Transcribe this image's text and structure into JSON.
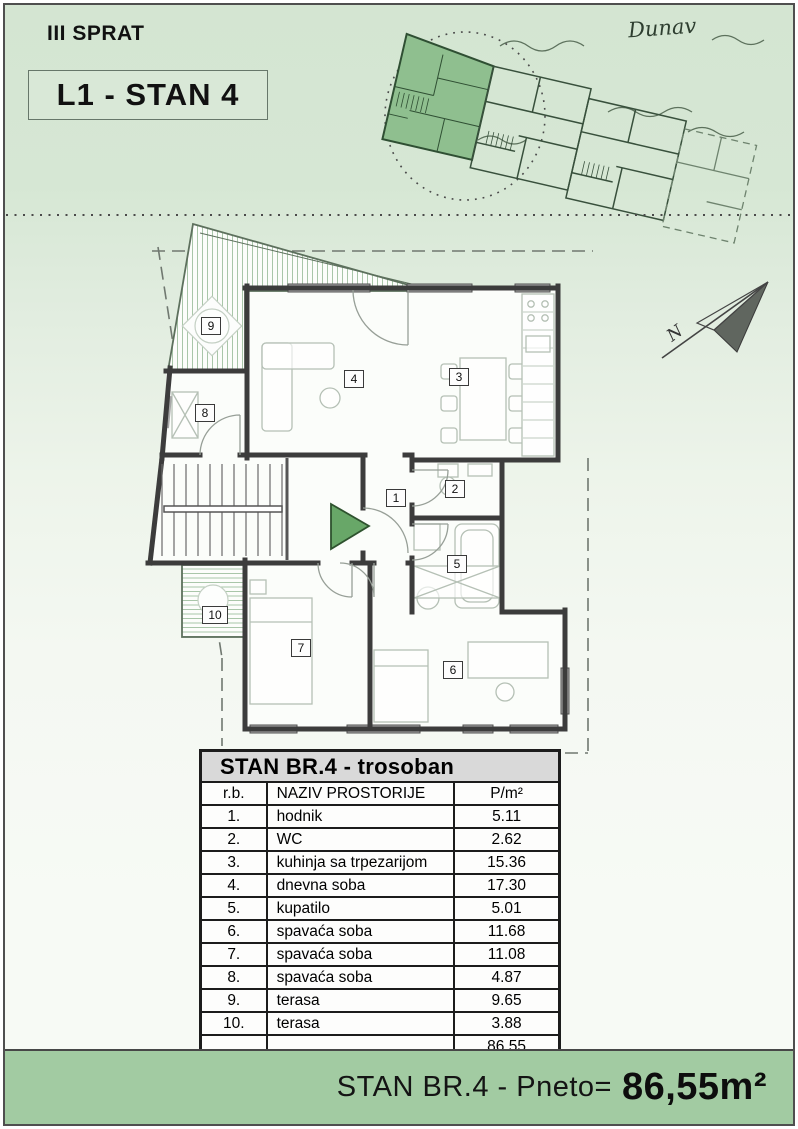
{
  "header": {
    "floor": "III SPRAT",
    "unit": "L1 - STAN 4"
  },
  "overview": {
    "river": "Dunav"
  },
  "compass": {
    "north": "N"
  },
  "plan": {
    "rooms": [
      {
        "num": "1"
      },
      {
        "num": "2"
      },
      {
        "num": "3"
      },
      {
        "num": "4"
      },
      {
        "num": "5"
      },
      {
        "num": "6"
      },
      {
        "num": "7"
      },
      {
        "num": "8"
      },
      {
        "num": "9"
      },
      {
        "num": "10"
      }
    ]
  },
  "table": {
    "title": "STAN BR.4 - trosoban",
    "headers": {
      "rb": "r.b.",
      "name": "NAZIV PROSTORIJE",
      "area": "P/m²"
    },
    "rows": [
      {
        "rb": "1.",
        "name": "hodnik",
        "area": "5.11"
      },
      {
        "rb": "2.",
        "name": "WC",
        "area": "2.62"
      },
      {
        "rb": "3.",
        "name": "kuhinja sa trpezarijom",
        "area": "15.36"
      },
      {
        "rb": "4.",
        "name": "dnevna soba",
        "area": "17.30"
      },
      {
        "rb": "5.",
        "name": "kupatilo",
        "area": "5.01"
      },
      {
        "rb": "6.",
        "name": "spavaća soba",
        "area": "11.68"
      },
      {
        "rb": "7.",
        "name": "spavaća soba",
        "area": "11.08"
      },
      {
        "rb": "8.",
        "name": "spavaća soba",
        "area": "4.87"
      },
      {
        "rb": "9.",
        "name": "terasa",
        "area": "9.65"
      },
      {
        "rb": "10.",
        "name": "terasa",
        "area": "3.88"
      }
    ],
    "total": "86.55"
  },
  "footer": {
    "label": "STAN BR.4 - Pneto=",
    "value": "86,55m²"
  },
  "colors": {
    "page_green": "#d5e6d3",
    "footer_green": "#a2cba2",
    "highlight_green": "#8fbf8f",
    "entrance_green": "#68a768",
    "wall": "#3c3c3c"
  }
}
